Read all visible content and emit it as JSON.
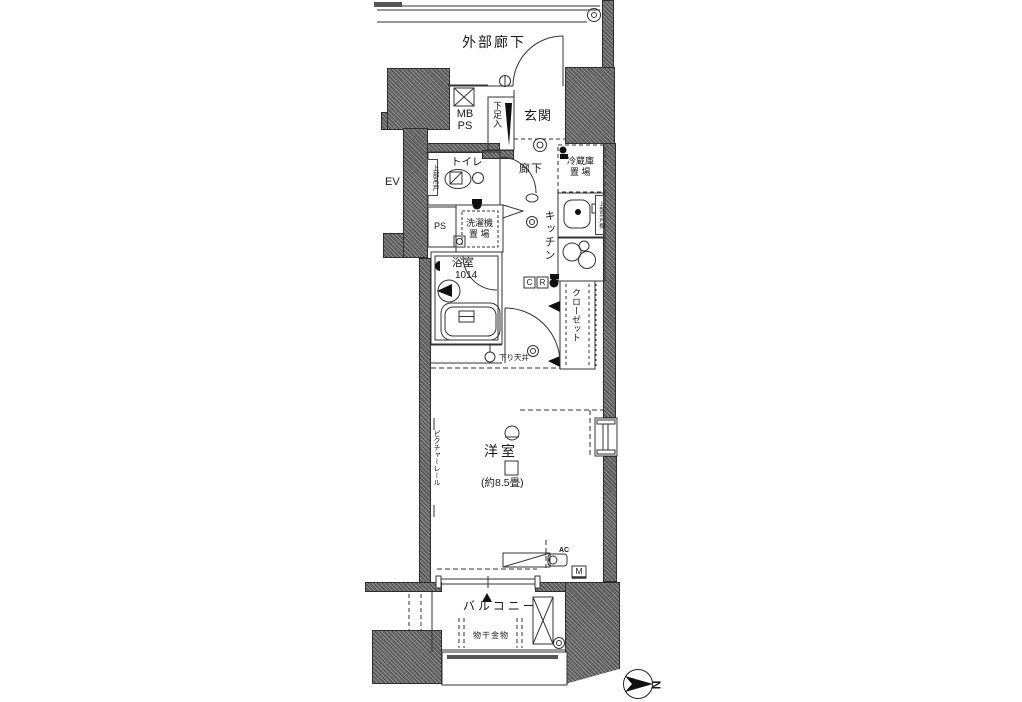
{
  "plan": {
    "labels": {
      "corridor": "外部廊下",
      "mb": "MB",
      "ps_top": "PS",
      "entrance": "玄関",
      "shoe_box": "下足入",
      "elevator": "EV",
      "toilet": "トイレ",
      "hallway": "廊下",
      "upper_cabinet_toilet": "上部吊戸",
      "fridge_line1": "冷蔵庫",
      "fridge_line2": "置 場",
      "kitchen": "キッチン",
      "upper_cabinet_kitchen": "上部吊戸棚",
      "ps_mid": "PS",
      "laundry_line1": "洗濯機",
      "laundry_line2": "置 場",
      "bath": "浴室",
      "bath_size": "1014",
      "c": "C",
      "r": "R",
      "closet": "クローゼット",
      "dropped_ceiling": "下り天井",
      "room": "洋室",
      "room_size": "(約8.5畳)",
      "picture_rail": "ピクチャーレール",
      "ac": "AC",
      "meter": "M",
      "balcony": "バルコニー",
      "drying_fixture": "物干金物",
      "north": "N"
    },
    "colors": {
      "wall": "#6e6e6e",
      "line": "#333333",
      "black": "#111111",
      "paper": "#ffffff"
    }
  }
}
